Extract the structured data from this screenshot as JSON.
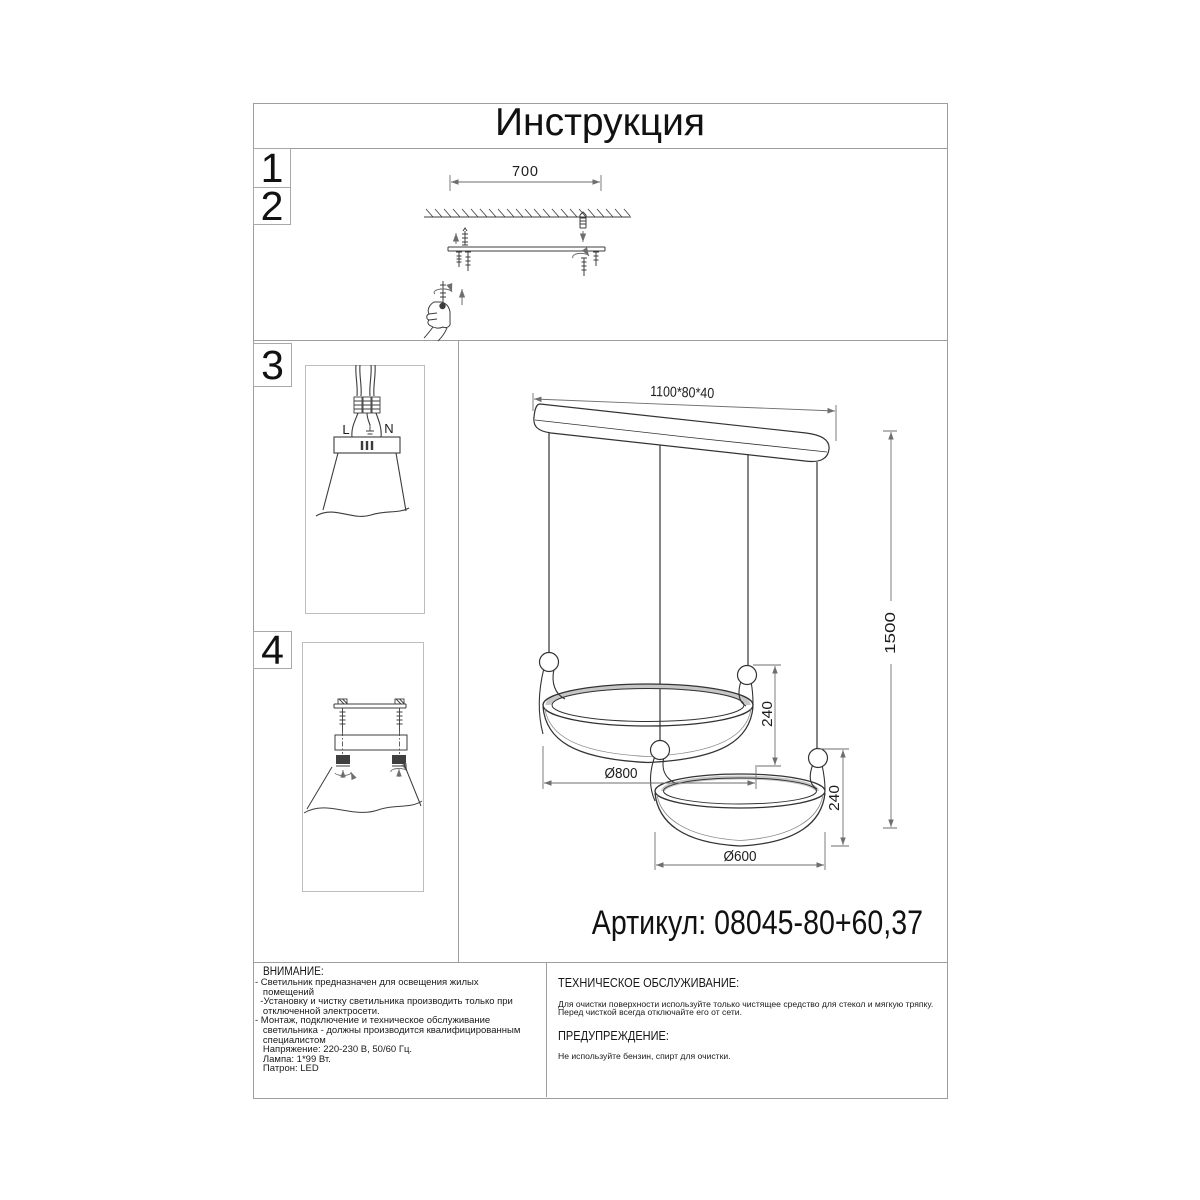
{
  "title": "Инструкция",
  "article": "Артикул: 08045-80+60,37",
  "steps": {
    "one": "1",
    "two": "2",
    "three": "3",
    "four": "4"
  },
  "dims": {
    "bracket_width": "700",
    "bar": "1100*80*40",
    "drop": "1500",
    "ring1_height": "240",
    "ring2_height": "240",
    "ring1_diameter": "Ø800",
    "ring2_diameter": "Ø600"
  },
  "wiring": {
    "live": "L",
    "neutral": "N"
  },
  "attention": {
    "heading": "ВНИМАНИЕ:",
    "lines": [
      "- Светильник предназначен для освещения жилых",
      "   помещений",
      "  -Установку и чистку светильника производить только при",
      "   отключенной электросети.",
      "- Монтаж, подключение и техническое обслуживание",
      "   светильника - должны производится квалифицированным",
      "   специалистом",
      "   Напряжение: 220-230 В, 50/60 Гц.",
      "   Лампа: 1*99 Вт.",
      "   Патрон: LED"
    ]
  },
  "maintenance": {
    "heading": "ТЕХНИЧЕСКОЕ ОБСЛУЖИВАНИЕ:",
    "line1": "Для очистки поверхности используйте только чистящее средство для стекол и мягкую тряпку.",
    "line2": "Перед чисткой всегда отключайте его от сети."
  },
  "warning": {
    "heading": "ПРЕДУПРЕЖДЕНИЕ:",
    "body": "Не используйте бензин, спирт для очистки."
  },
  "colors": {
    "line": "#3c3c3c",
    "frame": "#9e9e9e",
    "dim": "#6e6e6e"
  }
}
